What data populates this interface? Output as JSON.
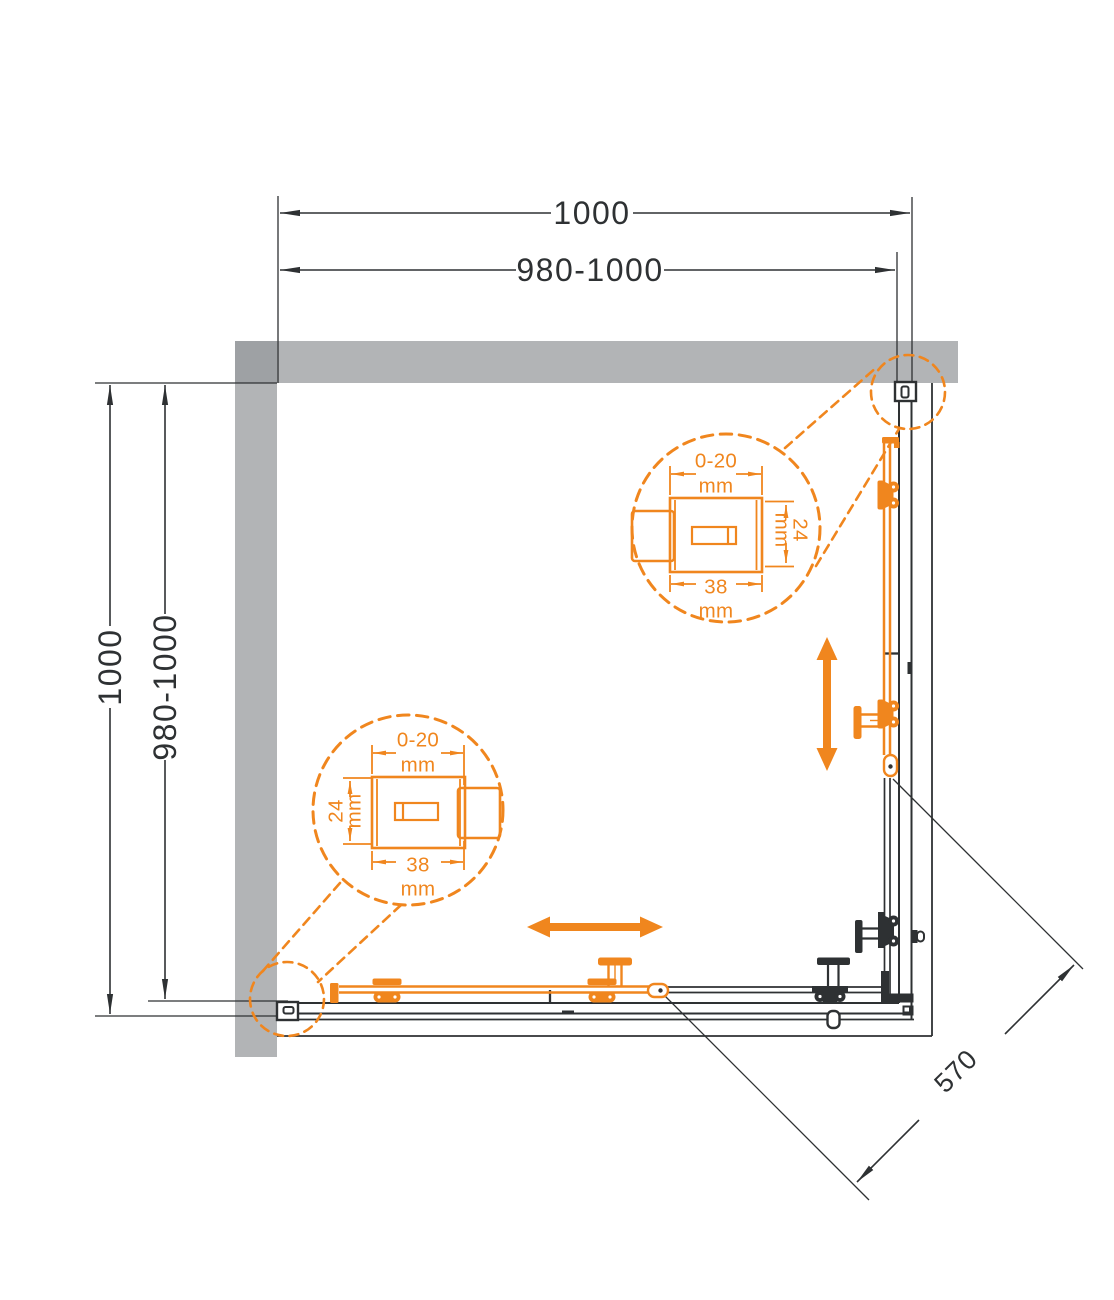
{
  "dimensions": {
    "top_width_outer": "1000",
    "top_width_adjust": "980-1000",
    "left_depth_outer": "1000",
    "left_depth_adjust": "980-1000",
    "diagonal_entry_width": "570"
  },
  "profile_detail": {
    "adjustment_range": "0-20",
    "unit": "mm",
    "profile_depth": "24",
    "profile_width": "38"
  },
  "colors": {
    "accent_orange": "#F0861E",
    "wall_gray": "#B2B4B6",
    "wall_corner_gray": "#9EA1A4",
    "line_dark": "#2E3133",
    "glass_white": "#FFFFFF"
  }
}
